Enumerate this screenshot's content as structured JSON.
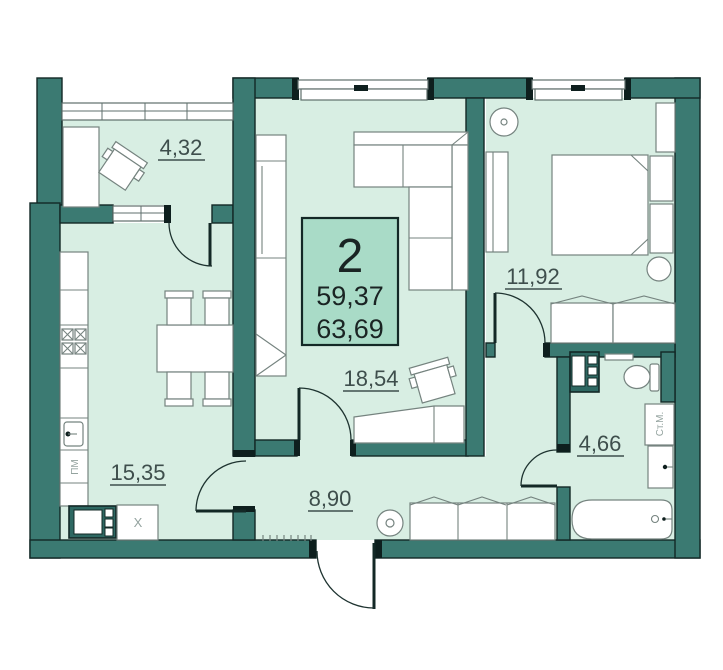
{
  "plan": {
    "unit": {
      "rooms_count": "2",
      "area_living": "59,37",
      "area_total": "63,69"
    },
    "rooms": {
      "balcony": {
        "area": "4,32"
      },
      "living": {
        "area": "18,54"
      },
      "bedroom": {
        "area": "11,92"
      },
      "kitchen": {
        "area": "15,35"
      },
      "hallway": {
        "area": "8,90"
      },
      "bathroom": {
        "area": "4,66"
      }
    },
    "appliances": {
      "washing_machine": "Ст.М.",
      "dishwasher": "ПМ",
      "fridge": "X"
    }
  },
  "colors": {
    "wall": "#3B7A72",
    "outline": "#132826",
    "room": "#D8EEE3",
    "box": "#A9DBC7",
    "text": "#3E4E4C",
    "line": "#5F6F6C",
    "furn": "#75837F",
    "arc": "#1E3330",
    "cap": "#0E1F1E",
    "darkunit": "#2E6862"
  }
}
